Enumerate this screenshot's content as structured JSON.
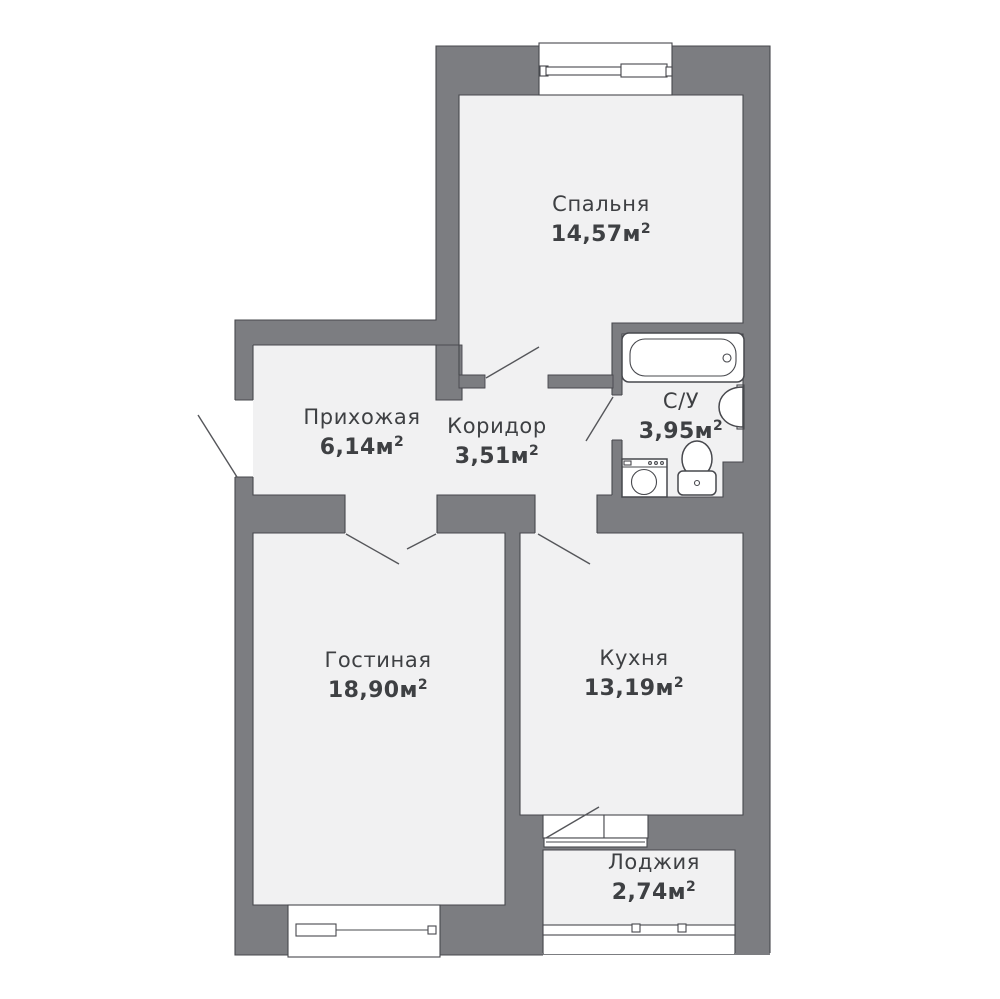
{
  "colors": {
    "wall": "#7c7d81",
    "floor": "#f1f1f2",
    "line": "#47484d",
    "text": "#3e4043"
  },
  "rooms": [
    {
      "id": "bedroom",
      "name": "Спальня",
      "area": "14,57м",
      "sup": "2"
    },
    {
      "id": "bathroom",
      "name": "С/У",
      "area": "3,95м",
      "sup": "2"
    },
    {
      "id": "hallway",
      "name": "Прихожая",
      "area": "6,14м",
      "sup": "2"
    },
    {
      "id": "corridor",
      "name": "Коридор",
      "area": "3,51м",
      "sup": "2"
    },
    {
      "id": "living",
      "name": "Гостиная",
      "area": "18,90м",
      "sup": "2"
    },
    {
      "id": "kitchen",
      "name": "Кухня",
      "area": "13,19м",
      "sup": "2"
    },
    {
      "id": "loggia",
      "name": "Лоджия",
      "area": "2,74м",
      "sup": "2"
    }
  ]
}
